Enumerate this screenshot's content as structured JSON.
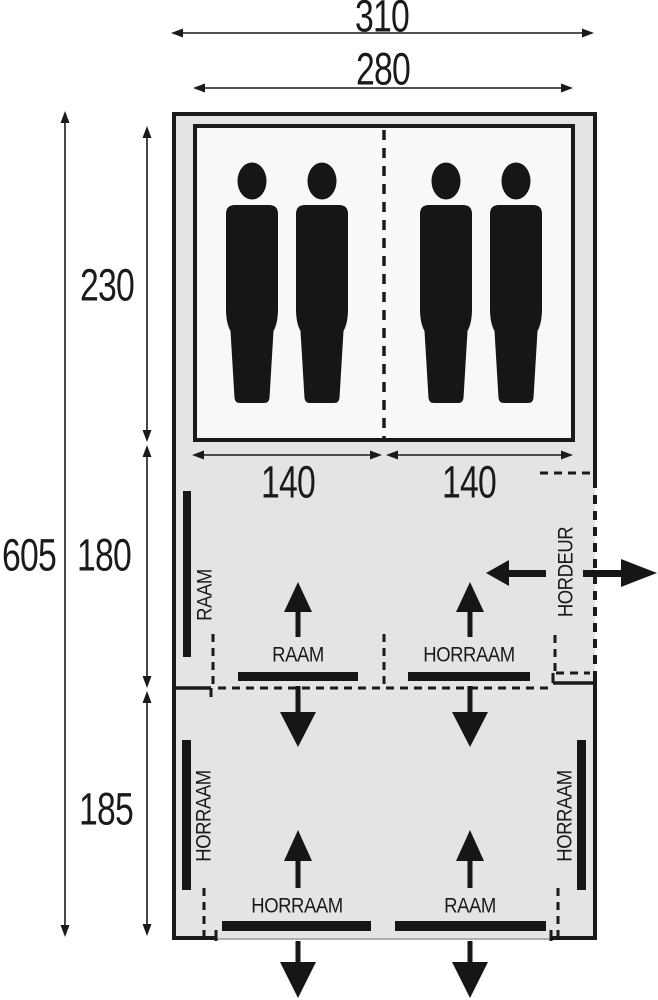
{
  "dimensions": {
    "width_outer": "310",
    "width_inner": "280",
    "length_total": "605",
    "length_sleeping": "230",
    "length_middle": "180",
    "length_front": "185",
    "bed_width_left": "140",
    "bed_width_right": "140"
  },
  "labels": {
    "side_window": "RAAM",
    "divider_window": "RAAM",
    "divider_screen_window": "HORRAAM",
    "screen_door": "HORDEUR",
    "front_left_side_window": "HORRAAM",
    "front_right_side_window": "HORRAAM",
    "front_bottom_left_window": "HORRAAM",
    "front_bottom_right_window": "RAAM"
  },
  "colors": {
    "tent_fill": "#e4e4e4",
    "cabin_fill": "#f8f8f8",
    "line": "#1a1a1a",
    "ink": "#161616"
  }
}
